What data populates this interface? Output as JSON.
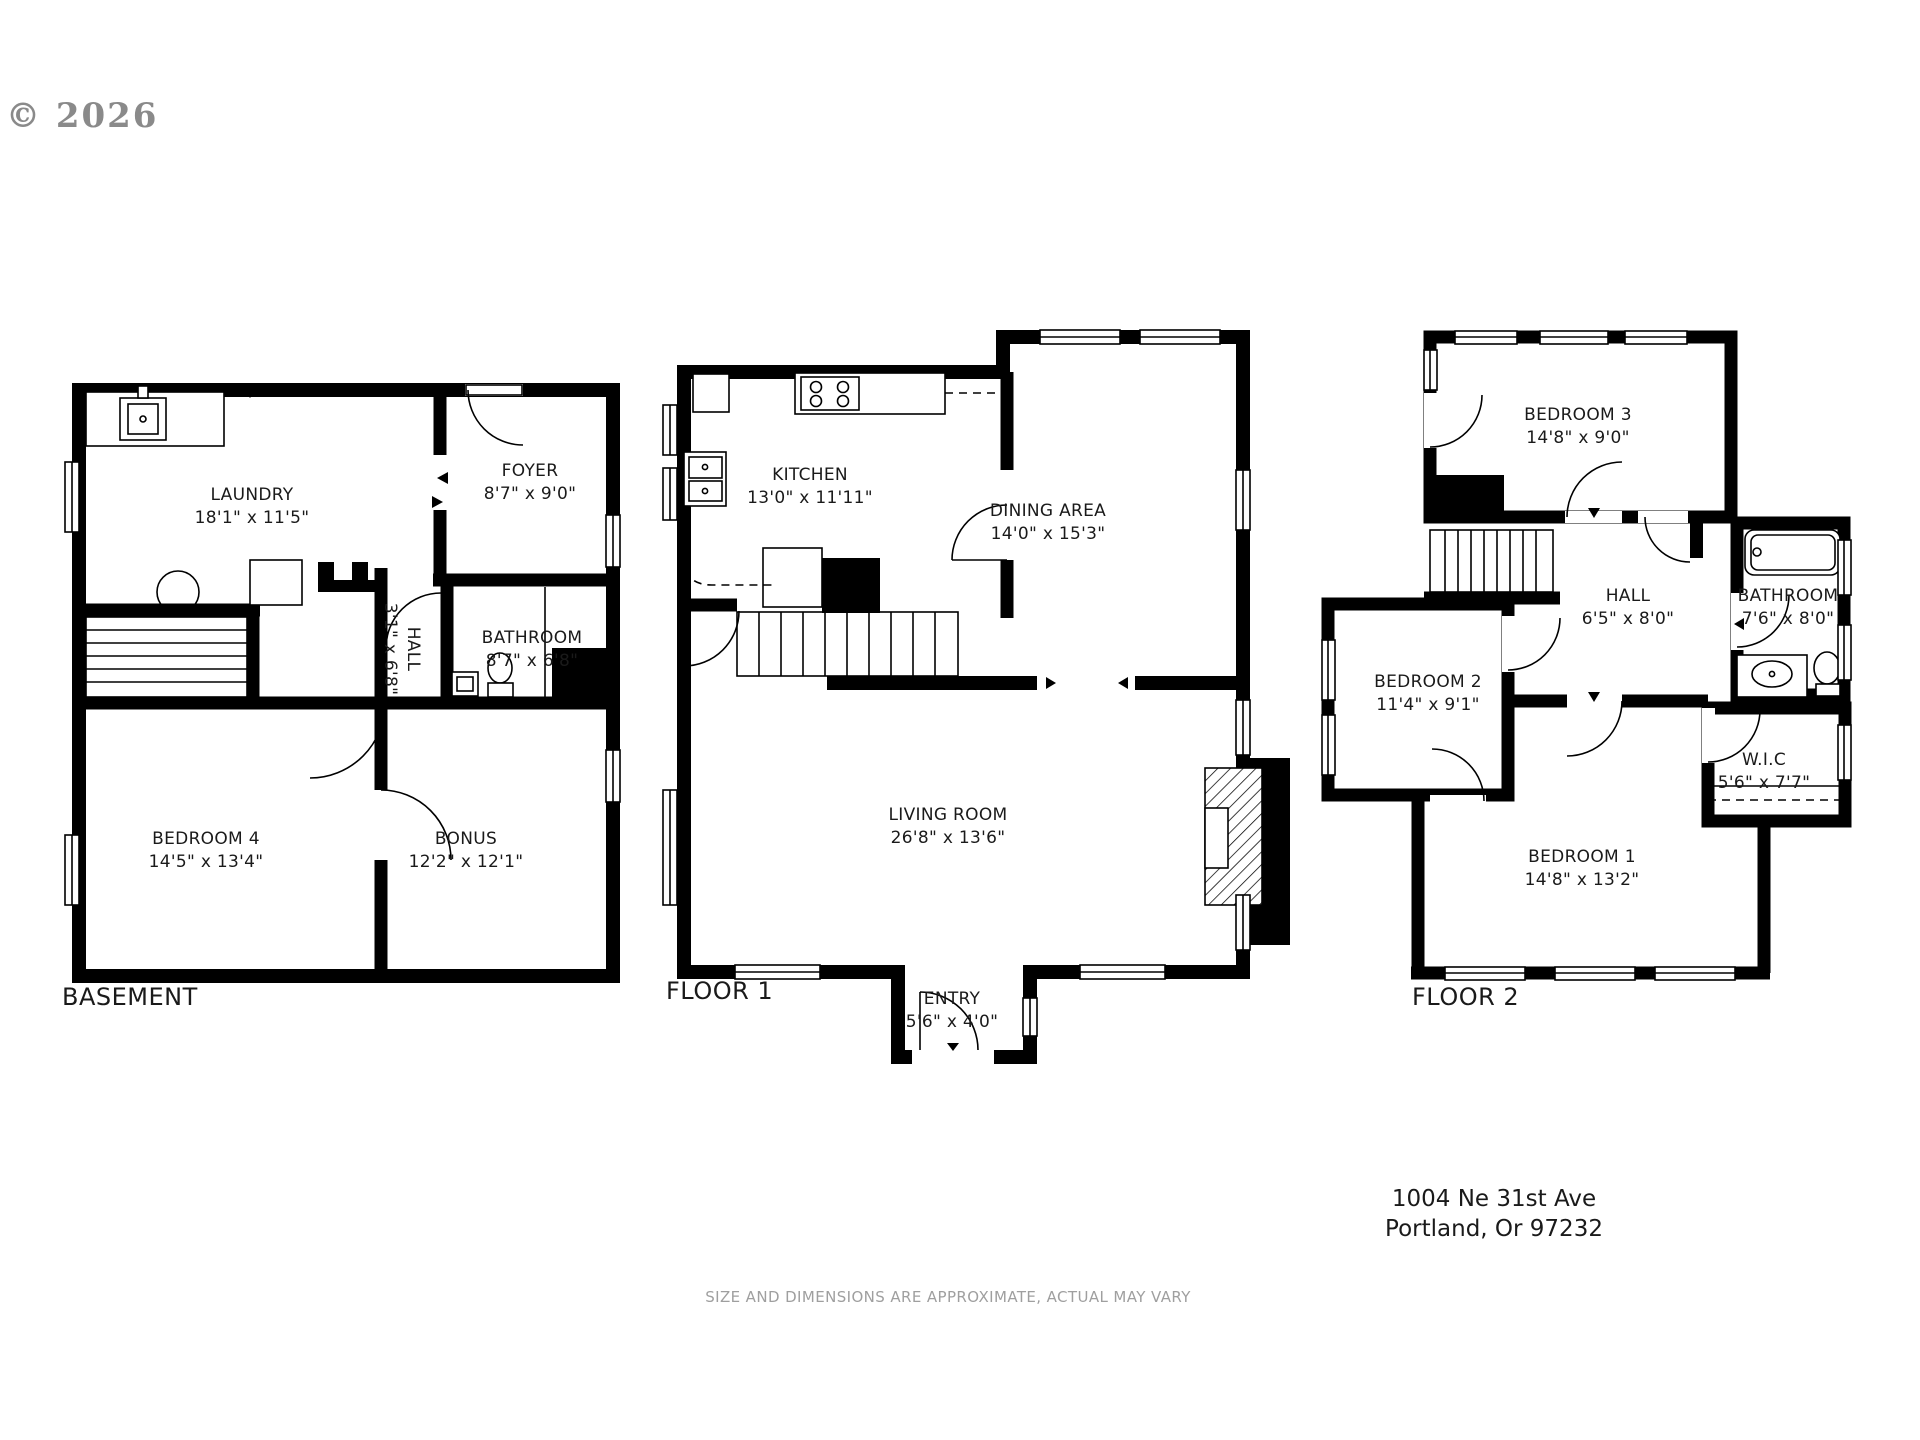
{
  "copyright": "© 2026",
  "colors": {
    "walls": "#000000",
    "label_text": "#1a1a1a",
    "watermark": "#8a8a8a",
    "disclaimer": "#9f9f9f"
  },
  "plans": [
    {
      "id": "basement",
      "title": "BASEMENT",
      "rooms": [
        {
          "key": "laundry",
          "name": "LAUNDRY",
          "dims": "18'1\" x 11'5\""
        },
        {
          "key": "foyer",
          "name": "FOYER",
          "dims": "8'7\" x 9'0\""
        },
        {
          "key": "hall",
          "name": "HALL",
          "dims": "3'1\" x 6'8\""
        },
        {
          "key": "bathroom",
          "name": "BATHROOM",
          "dims": "8'7\" x 6'8\""
        },
        {
          "key": "bedroom4",
          "name": "BEDROOM 4",
          "dims": "14'5\" x 13'4\""
        },
        {
          "key": "bonus",
          "name": "BONUS",
          "dims": "12'2\" x 12'1\""
        }
      ]
    },
    {
      "id": "floor1",
      "title": "FLOOR 1",
      "rooms": [
        {
          "key": "kitchen",
          "name": "KITCHEN",
          "dims": "13'0\" x 11'11\""
        },
        {
          "key": "dining",
          "name": "DINING AREA",
          "dims": "14'0\" x 15'3\""
        },
        {
          "key": "living",
          "name": "LIVING ROOM",
          "dims": "26'8\" x 13'6\""
        },
        {
          "key": "entry",
          "name": "ENTRY",
          "dims": "5'6\" x 4'0\""
        }
      ]
    },
    {
      "id": "floor2",
      "title": "FLOOR 2",
      "rooms": [
        {
          "key": "bedroom3",
          "name": "BEDROOM 3",
          "dims": "14'8\" x 9'0\""
        },
        {
          "key": "hall",
          "name": "HALL",
          "dims": "6'5\" x 8'0\""
        },
        {
          "key": "bathroom",
          "name": "BATHROOM",
          "dims": "7'6\" x 8'0\""
        },
        {
          "key": "bedroom2",
          "name": "BEDROOM 2",
          "dims": "11'4\" x 9'1\""
        },
        {
          "key": "wic",
          "name": "W.I.C",
          "dims": "5'6\" x 7'7\""
        },
        {
          "key": "bedroom1",
          "name": "BEDROOM 1",
          "dims": "14'8\" x 13'2\""
        }
      ]
    }
  ],
  "address": {
    "line1": "1004 Ne 31st Ave",
    "line2": "Portland, Or  97232"
  },
  "disclaimer": "SIZE AND DIMENSIONS ARE APPROXIMATE, ACTUAL MAY VARY"
}
